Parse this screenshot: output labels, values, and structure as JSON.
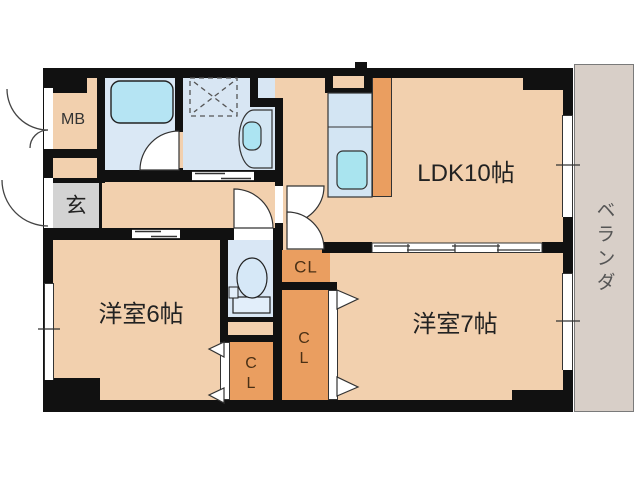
{
  "floorplan": {
    "labels": {
      "ldk": "LDK10帖",
      "west_room_6": "洋室6帖",
      "west_room_7": "洋室7帖",
      "entrance": "玄",
      "meter_box": "MB",
      "closet_hall": "CL",
      "closet_tall": "CL",
      "closet_small": "CL",
      "veranda": "ベランダ"
    },
    "fixtures": [
      "bathtub",
      "washing-machine-pan",
      "washbasin",
      "toilet",
      "kitchen-sink"
    ],
    "colors": {
      "wall": "#111111",
      "floor": "#f2d0ae",
      "wet_area_floor": "#d9e7f5",
      "closet": "#ea9e60",
      "entrance_floor": "#d3d3d3",
      "veranda_floor": "#d8cfc8",
      "fixture_blue": "#aee5f1",
      "counter_blue": "#d3e5f3"
    }
  }
}
